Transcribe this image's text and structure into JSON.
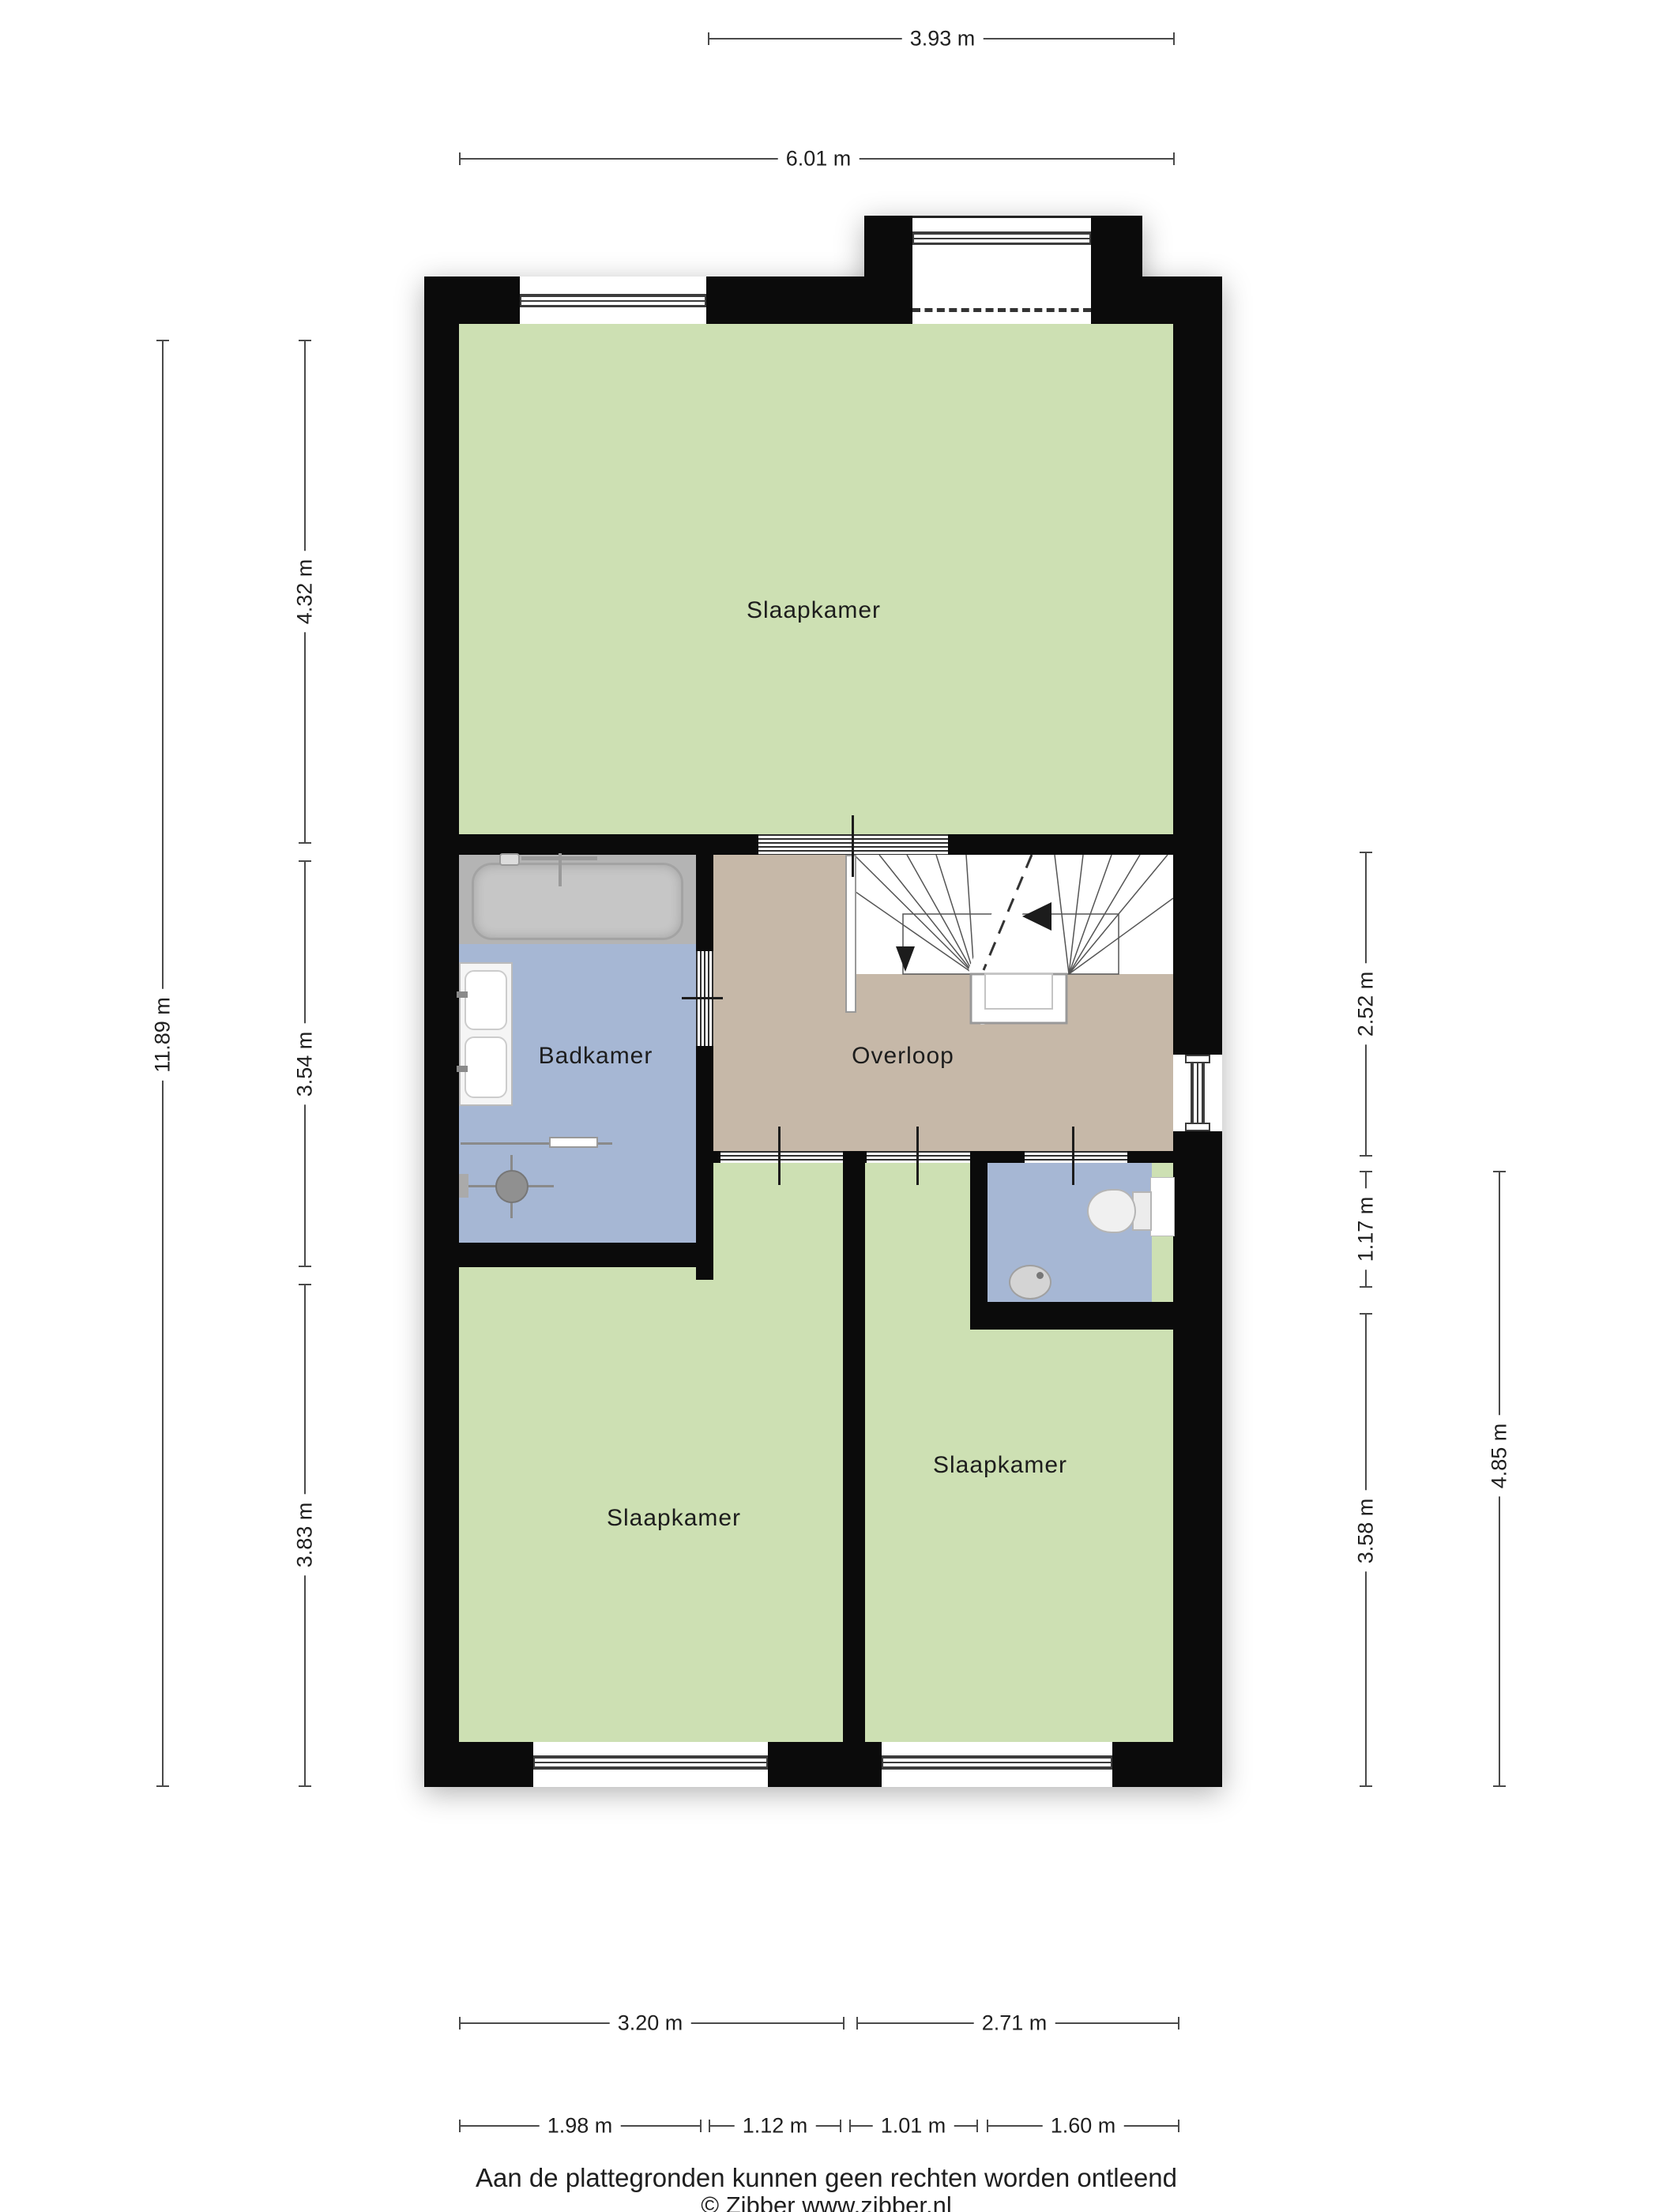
{
  "title": "Floor plan - first floor (Dutch)",
  "rooms": {
    "bedroom_top": "Slaapkamer",
    "bathroom": "Badkamer",
    "landing": "Overloop",
    "bedroom_left": "Slaapkamer",
    "bedroom_right": "Slaapkamer"
  },
  "dims": {
    "top": [
      {
        "label": "3.93 m"
      },
      {
        "label": "6.01 m"
      }
    ],
    "left": [
      {
        "label": "11.89 m"
      },
      {
        "label": "4.32 m"
      },
      {
        "label": "3.54 m"
      },
      {
        "label": "3.83 m"
      }
    ],
    "right": [
      {
        "label": "2.52 m"
      },
      {
        "label": "1.17 m"
      },
      {
        "label": "3.58 m"
      },
      {
        "label": "4.85 m"
      }
    ],
    "bottom": [
      {
        "label": "3.20 m"
      },
      {
        "label": "2.71 m"
      },
      {
        "label": "1.98 m"
      },
      {
        "label": "1.12 m"
      },
      {
        "label": "1.01 m"
      },
      {
        "label": "1.60 m"
      }
    ]
  },
  "footer": {
    "disclaimer": "Aan de plattegronden kunnen geen rechten worden ontleend",
    "copyright": "© Zibber www.zibber.nl"
  },
  "colors": {
    "wall": "#0b0b0b",
    "green": "#cde0b3",
    "blue": "#a6b7d4",
    "tan": "#c6b8a8",
    "bathzone": "#b4b4b4",
    "dim": "#4a4a4a",
    "ink": "#262626",
    "paper": "#ffffff"
  }
}
